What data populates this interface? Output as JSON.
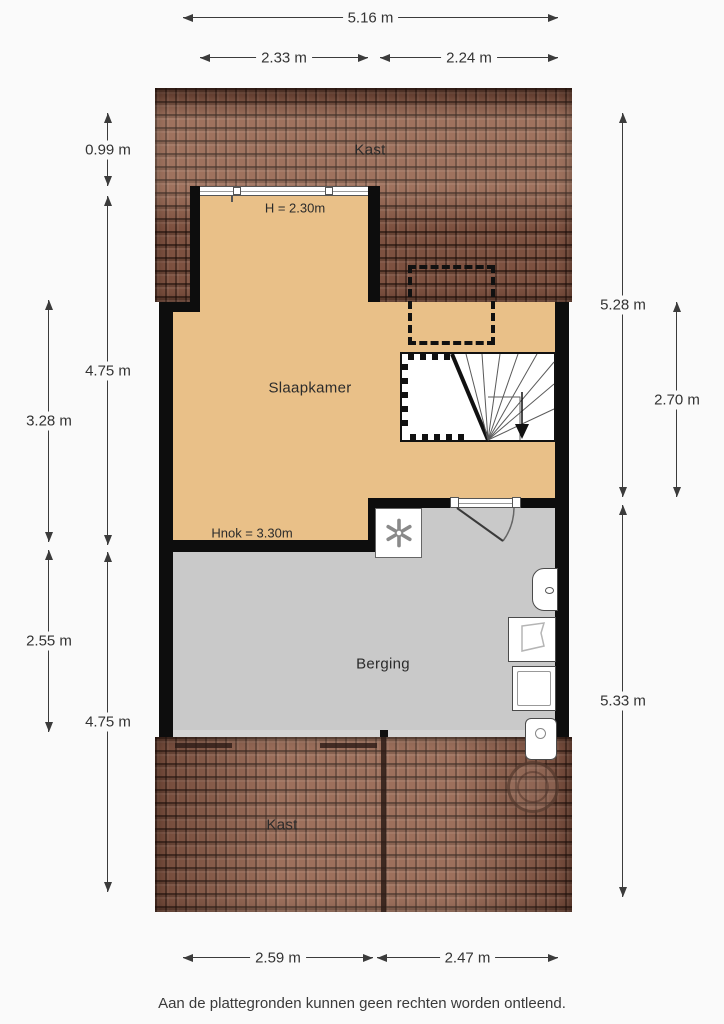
{
  "page": {
    "background": "#fafafa",
    "disclaimer": "Aan de plattegronden kunnen geen rechten worden ontleend."
  },
  "floorplan": {
    "rooms": {
      "kast_top": {
        "label": "Kast"
      },
      "slaapkamer": {
        "label": "Slaapkamer",
        "height_note": "H = 2.30m",
        "ridge_note": "Hnok = 3.30m"
      },
      "berging": {
        "label": "Berging"
      },
      "kast_bottom": {
        "label": "Kast"
      }
    },
    "colors": {
      "floor_wood": "#e9c088",
      "floor_concrete": "#c9c9c9",
      "roof_tiles": "#8a5a47",
      "wall": "#0d0d0d"
    }
  },
  "dimensions": {
    "top": [
      {
        "label": "5.16 m"
      },
      {
        "label": "2.33 m"
      },
      {
        "label": "2.24 m"
      }
    ],
    "left": [
      {
        "label": "0.99 m"
      },
      {
        "label": "4.75 m"
      },
      {
        "label": "3.28 m"
      },
      {
        "label": "2.55 m"
      },
      {
        "label": "4.75 m"
      }
    ],
    "right": [
      {
        "label": "5.28 m"
      },
      {
        "label": "2.70 m"
      },
      {
        "label": "5.33 m"
      }
    ],
    "bottom": [
      {
        "label": "2.59 m"
      },
      {
        "label": "2.47 m"
      }
    ]
  }
}
